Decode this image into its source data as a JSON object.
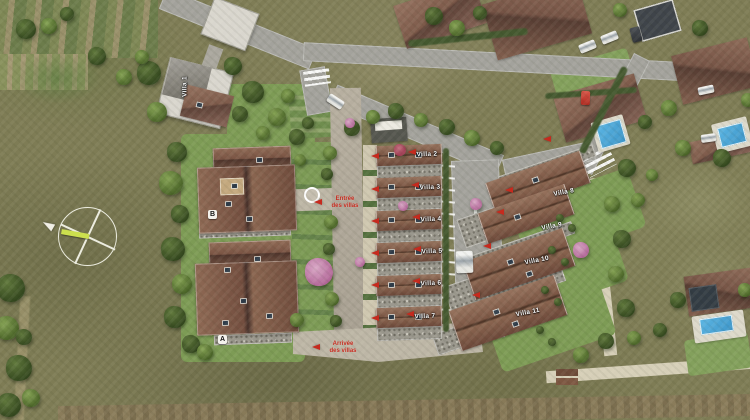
{
  "site": {
    "villas": [
      {
        "name": "Villa 1"
      },
      {
        "name": "Villa 2"
      },
      {
        "name": "Villa 3"
      },
      {
        "name": "Villa 4"
      },
      {
        "name": "Villa 5"
      },
      {
        "name": "Villa 6"
      },
      {
        "name": "Villa 7"
      },
      {
        "name": "Villa 8"
      },
      {
        "name": "Villa 9"
      },
      {
        "name": "Villa 10"
      },
      {
        "name": "Villa 11"
      }
    ],
    "building_markers": [
      {
        "label": "B"
      },
      {
        "label": "A"
      }
    ],
    "annotations": [
      {
        "line1": "Entrée",
        "line2": "des villas"
      },
      {
        "line1": "Arrivée",
        "line2": "des villas"
      }
    ]
  },
  "colors": {
    "marker_red": "#c62a1e",
    "roof_brown": "#7d5847",
    "terrace_gray": "#9b988e",
    "lawn_green": "#7d9b55",
    "road_gray": "#a3a29c",
    "walkway_beige": "#bdb6a6",
    "pool_blue": "#3d95c8",
    "field_olive": "#7e7c55",
    "compass_needle_yellow": "#ccdf4e"
  }
}
